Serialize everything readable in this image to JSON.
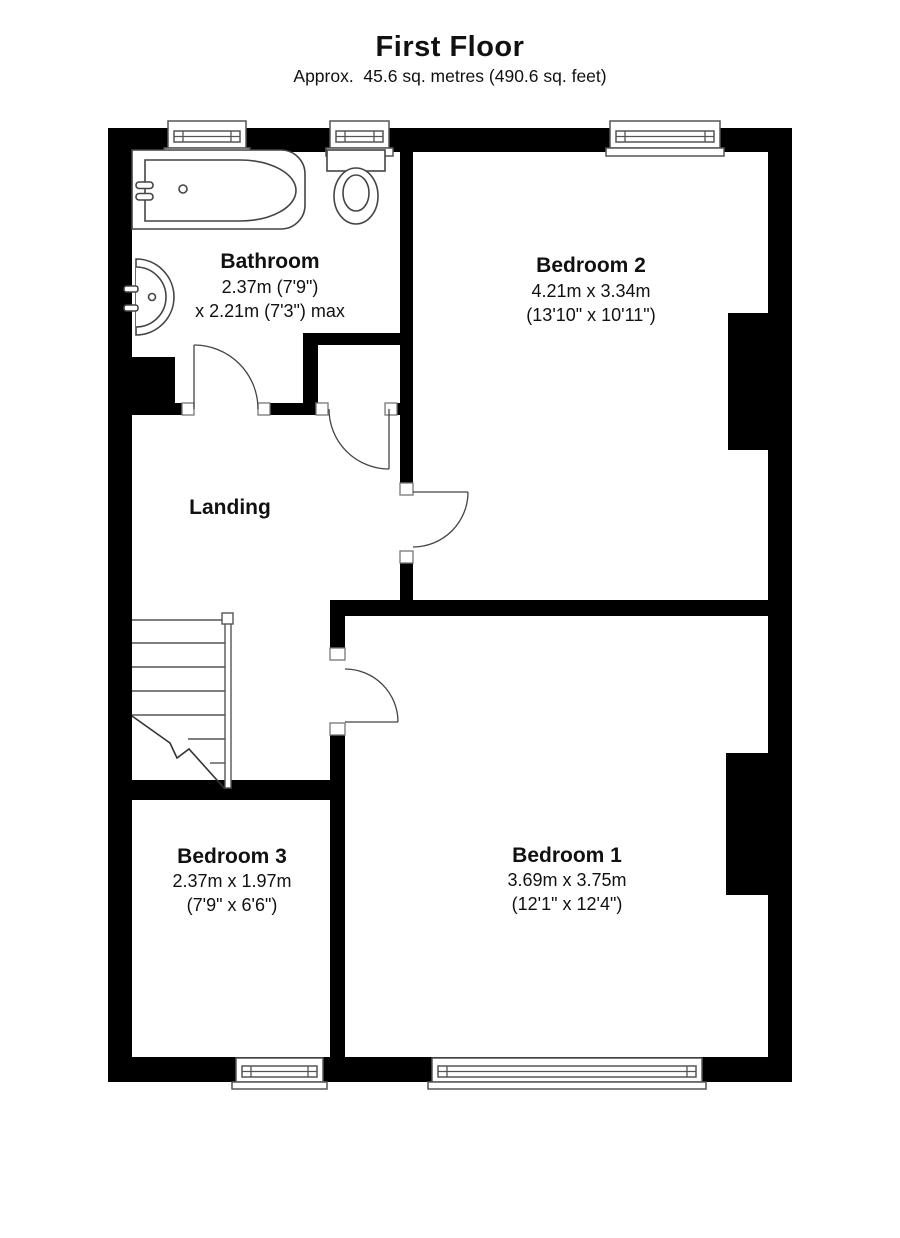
{
  "header": {
    "title": "First Floor",
    "subtitle": "Approx.  45.6 sq. metres (490.6 sq. feet)"
  },
  "rooms": {
    "bathroom": {
      "name": "Bathroom",
      "dims": [
        "2.37m (7'9\")",
        "x 2.21m (7'3\") max"
      ]
    },
    "bedroom2": {
      "name": "Bedroom 2",
      "dims": [
        "4.21m x 3.34m",
        "(13'10\" x 10'11\")"
      ]
    },
    "landing": {
      "name": "Landing"
    },
    "bedroom3": {
      "name": "Bedroom 3",
      "dims": [
        "2.37m x 1.97m",
        "(7'9\" x 6'6\")"
      ]
    },
    "bedroom1": {
      "name": "Bedroom 1",
      "dims": [
        "3.69m x 3.75m",
        "(12'1\" x 12'4\")"
      ]
    }
  },
  "colors": {
    "wall": "#000000",
    "thin_line": "#4d4d4d",
    "background": "#ffffff",
    "text": "#111111"
  }
}
